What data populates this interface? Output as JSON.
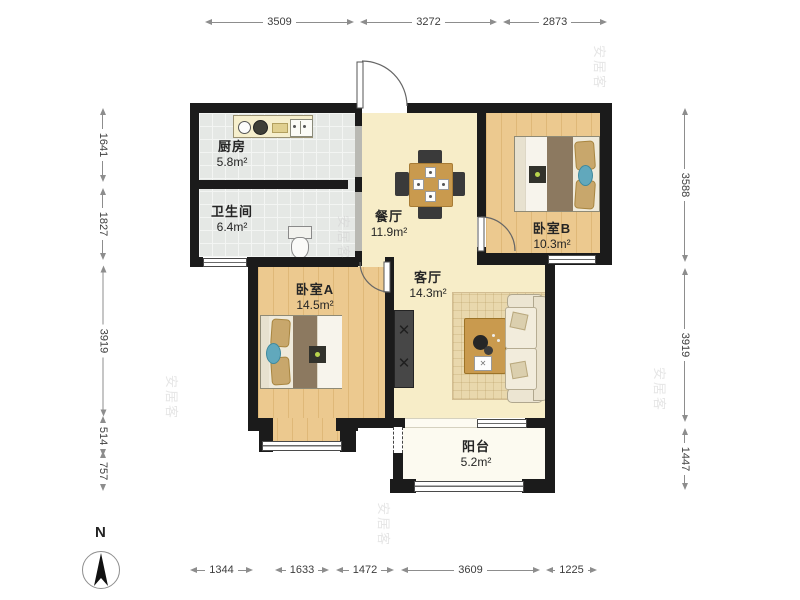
{
  "rooms": {
    "kitchen": {
      "name": "厨房",
      "area": "5.8m²"
    },
    "bathroom": {
      "name": "卫生间",
      "area": "6.4m²"
    },
    "dining": {
      "name": "餐厅",
      "area": "11.9m²"
    },
    "bedroomB": {
      "name": "卧室B",
      "area": "10.3m²"
    },
    "bedroomA": {
      "name": "卧室A",
      "area": "14.5m²"
    },
    "living": {
      "name": "客厅",
      "area": "14.3m²"
    },
    "balcony": {
      "name": "阳台",
      "area": "5.2m²"
    }
  },
  "dims": {
    "top": [
      "3509",
      "3272",
      "2873"
    ],
    "left": [
      "1641",
      "1827",
      "3919",
      "514",
      "757"
    ],
    "right": [
      "3588",
      "3919",
      "1447"
    ],
    "bottom": [
      "1344",
      "1633",
      "1472",
      "3609",
      "1225"
    ]
  },
  "compass": {
    "label": "N"
  },
  "watermark": {
    "text": "安居客"
  },
  "colors": {
    "wall": "#1b1b1b",
    "wood_floor": "#ecc98f",
    "tile_floor": "#e5e8e5",
    "cream_floor": "#f7edc8",
    "accent_teal": "#61a8bc"
  }
}
